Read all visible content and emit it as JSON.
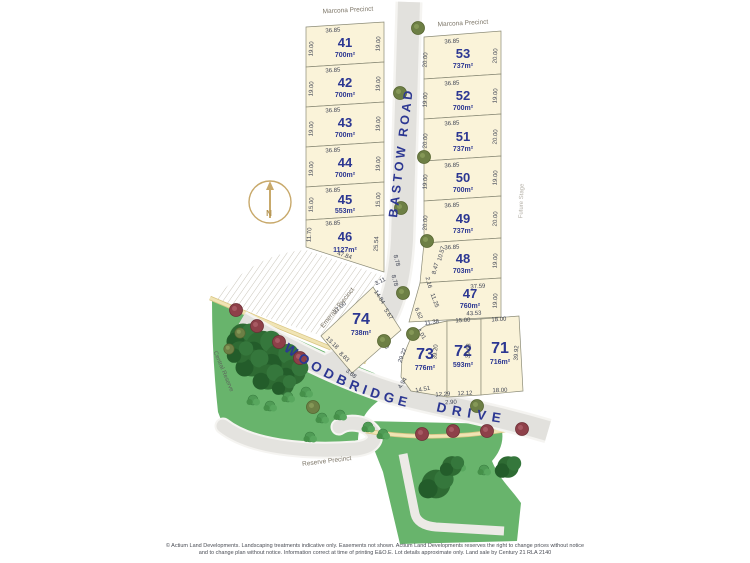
{
  "title": {
    "line1": "Marcona 2",
    "line2": "Precinct"
  },
  "labels": {
    "marcona_precinct": "Marcona Precinct",
    "emerald_precinct": "Emerald Precinct",
    "central_reserve": "Central Reserve",
    "reserve_precinct": "Reserve Precinct",
    "future_stage": "Future Stage",
    "north": "N"
  },
  "roads": {
    "bastow": "BASTOW ROAD",
    "woodbridge": "WOODBRIDGE",
    "drive": "DRIVE"
  },
  "lots": [
    {
      "number": "41",
      "area": "700m²",
      "dims": {
        "top": "36.85",
        "left": "19.00",
        "right": "19.00"
      }
    },
    {
      "number": "42",
      "area": "700m²",
      "dims": {
        "top": "36.85",
        "left": "19.00",
        "right": "19.00"
      }
    },
    {
      "number": "43",
      "area": "700m²",
      "dims": {
        "top": "36.85",
        "left": "19.00",
        "right": "19.00"
      }
    },
    {
      "number": "44",
      "area": "700m²",
      "dims": {
        "top": "36.85",
        "left": "19.00",
        "right": "19.00"
      }
    },
    {
      "number": "45",
      "area": "553m²",
      "dims": {
        "top": "36.85",
        "left": "15.00",
        "right": "15.00"
      }
    },
    {
      "number": "46",
      "area": "1127m²",
      "dims": {
        "top": "36.85",
        "left": "11.70",
        "right": "25.54",
        "diag": "47.84"
      }
    },
    {
      "number": "53",
      "area": "737m²",
      "dims": {
        "top": "36.85",
        "left": "20.00",
        "right": "20.00"
      }
    },
    {
      "number": "52",
      "area": "700m²",
      "dims": {
        "top": "36.85",
        "left": "19.00",
        "right": "19.00"
      }
    },
    {
      "number": "51",
      "area": "737m²",
      "dims": {
        "top": "36.85",
        "left": "20.00",
        "right": "20.00"
      }
    },
    {
      "number": "50",
      "area": "700m²",
      "dims": {
        "top": "36.85",
        "left": "19.00",
        "right": "19.00"
      }
    },
    {
      "number": "49",
      "area": "737m²",
      "dims": {
        "top": "36.85",
        "left": "20.00",
        "right": "20.00"
      }
    },
    {
      "number": "48",
      "area": "703m²",
      "dims": {
        "top": "36.85",
        "left1": "10.57",
        "left2": "8.47",
        "right": "19.00"
      }
    },
    {
      "number": "47",
      "area": "760m²",
      "dims": {
        "top": "37.59",
        "left1": "2.16",
        "left2": "11.25",
        "left3": "6.62",
        "right": "19.00",
        "bottom": "43.53"
      }
    },
    {
      "number": "74",
      "area": "738m²",
      "dims": {
        "nw": "37.00",
        "top": "3.11",
        "ne1": "14.84",
        "ne2": "5.67",
        "ne3": "8.78",
        "ne4": "8.78",
        "sw1": "13.18",
        "sw2": "8.83",
        "sw3": "3.88",
        "se": "28.60"
      }
    },
    {
      "number": "73",
      "area": "776m²",
      "dims": {
        "top1": "11.38",
        "top2": "4.01",
        "left1": "29.22",
        "left2": "4.94",
        "inner": "39.20",
        "bottom1": "14.51",
        "bottom2": "12.29"
      }
    },
    {
      "number": "72",
      "area": "593m²",
      "dims": {
        "top": "15.00",
        "side": "39.68",
        "bottom": "12.12",
        "bottom2": "2.90"
      }
    },
    {
      "number": "71",
      "area": "716m²",
      "dims": {
        "top": "18.00",
        "right": "39.92",
        "bottom": "18.00"
      }
    }
  ],
  "disclaimer": {
    "line1": "© Actium Land Developments. Landscaping treatments indicative only. Easements not shown. Actium Land Developments reserves the right to change prices without notice",
    "line2": "and to change plan without notice. Information correct at time of printing E&O.E. Lot details approximate only. Land sale by Century 21 RLA 2140"
  },
  "colors": {
    "lot_fill": "#faf3d9",
    "lot_number": "#2c3792",
    "road_fill": "#e2e1dd",
    "green": "#68b46c",
    "accent_gold": "#c8a96b"
  }
}
